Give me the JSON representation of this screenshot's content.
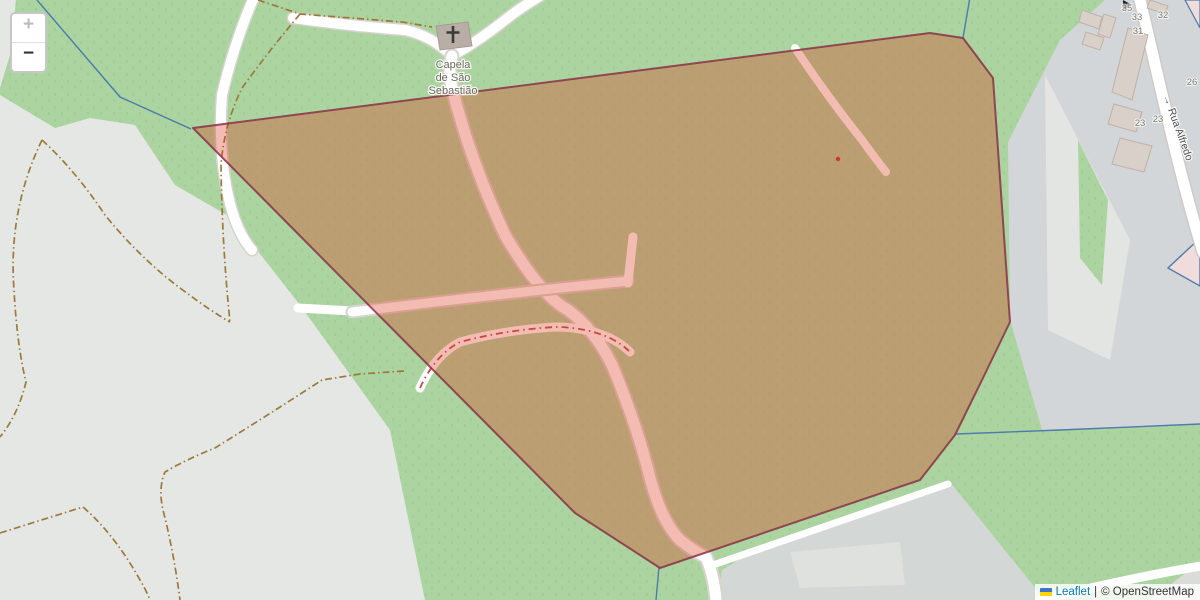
{
  "map": {
    "zoom_control": {
      "zoom_in_label": "+",
      "zoom_out_label": "−"
    },
    "poi": {
      "chapel_name_lines": [
        "Capela",
        "de São",
        "Sebastião"
      ]
    },
    "streets": {
      "name": "Rua Alfredo",
      "oneway_arrow": "→"
    },
    "house_numbers": [
      "35",
      "33",
      "32",
      "31",
      "26",
      "23",
      "23"
    ],
    "attribution": {
      "flag_icon": "ukraine-flag",
      "leaflet_link": "Leaflet",
      "separator": "|",
      "copyright": "© OpenStreetMap"
    },
    "colors": {
      "vegetation_green": "#abd4a0",
      "bare_gray": "#e4e7e3",
      "urban_gray": "#d3d6d8",
      "overlay_fill": "#dc3c1e",
      "overlay_fill_opacity": "0.34",
      "overlay_stroke": "#8a3148",
      "admin_boundary_blue": "#4d7bab",
      "track_brown": "#9c7a3c",
      "building_fill": "#d9d0c9"
    }
  }
}
